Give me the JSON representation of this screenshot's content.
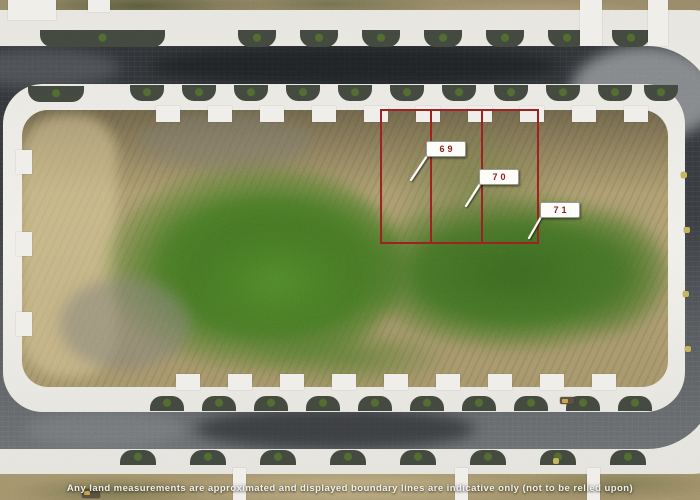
{
  "annotation": {
    "lots": [
      {
        "number": "69"
      },
      {
        "number": "70"
      },
      {
        "number": "71"
      }
    ],
    "boundary_color": "#9e2222",
    "label_text_color": "#8a1c1c",
    "leader_color": "#ffffff"
  },
  "footer": {
    "disclaimer": "Any land measurements are approximated and displayed boundary lines are indicative only (not to be relied upon)"
  }
}
